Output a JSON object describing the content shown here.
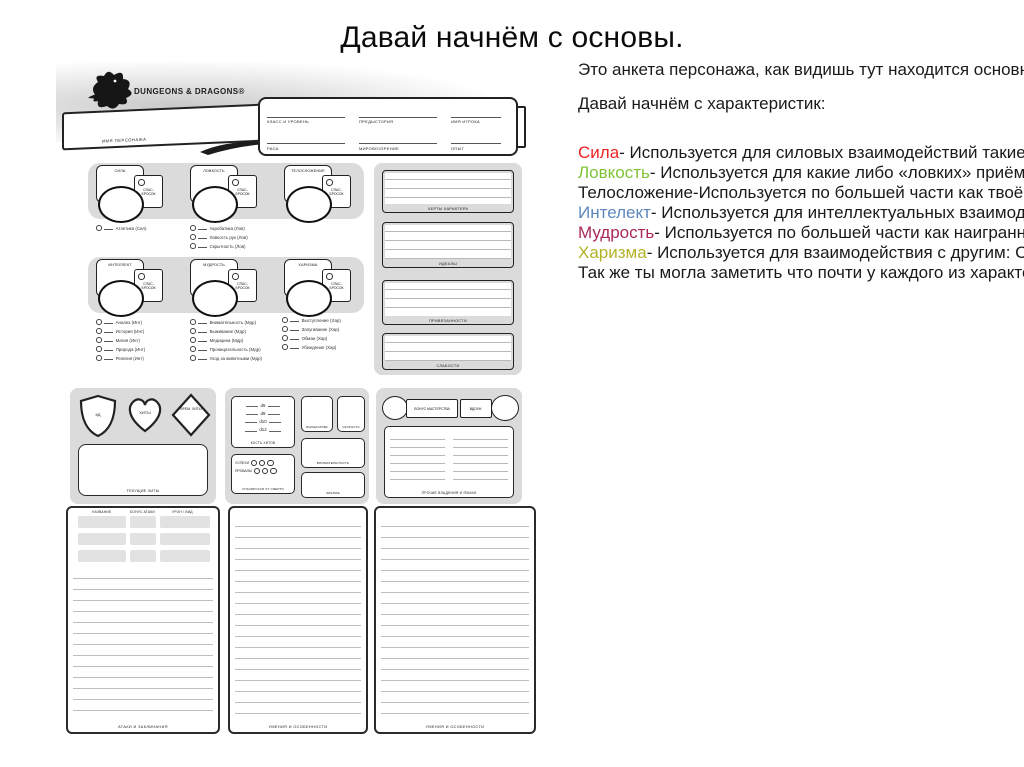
{
  "slide": {
    "title": "Давай начнём с основы."
  },
  "notes": {
    "lines": [
      {
        "text": "Это анкета персонажа, как видишь тут находится основн"
      },
      {
        "text": " Давай начнём с характеристик:"
      },
      {
        "term": "Сила",
        "color": "#ee2222",
        "rest": "- Используется для силовых взаимодействий такие"
      },
      {
        "term": "Ловкость",
        "color": "#7fc437",
        "rest": "- Используется для какие либо «ловких» приём"
      },
      {
        "text": "Телосложение-Используется по большей части как твоё"
      },
      {
        "term": "Интелект",
        "color": "#5e87bd",
        "rest": "- Используется для интеллектуальных взаимоде"
      },
      {
        "term": "Мудрость",
        "color": "#a82a5a",
        "rest": "- Используется по большей части как наигранн"
      },
      {
        "term": "Харизма",
        "color": "#b3b329",
        "rest": "- Используется для взаимодействия с другим: С"
      },
      {
        "text": "Так же ты могла заметить что почти у каждого из характе"
      }
    ]
  },
  "sheet": {
    "logo": "DUNGEONS & DRAGONS®",
    "name_label": "ИМЯ ПЕРСОНАЖА",
    "fields": [
      "КЛАСС И УРОВЕНЬ",
      "ПРЕДЫСТОРИЯ",
      "ИМЯ ИГРОКА",
      "РАСА",
      "МИРОВОЗЗРЕНИЕ",
      "ОПЫТ"
    ],
    "save_label": "СПАС-\nБРОСОК",
    "row1": [
      {
        "name": "СИЛА",
        "skills": [
          "Атлетика (Сил)"
        ]
      },
      {
        "name": "ЛОВКОСТЬ",
        "skills": [
          "Акробатика (Лов)",
          "Ловкость рук (Лов)",
          "Скрытность (Лов)"
        ]
      },
      {
        "name": "ТЕЛОСЛОЖЕНИЕ",
        "skills": []
      }
    ],
    "row2": [
      {
        "name": "ИНТЕЛЛЕКТ",
        "skills": [
          "Анализ (Инт)",
          "История (Инт)",
          "Магия (Инт)",
          "Природа (Инт)",
          "Религия (Инт)"
        ]
      },
      {
        "name": "МУДРОСТЬ",
        "skills": [
          "Внимательность (Мдр)",
          "Выживание (Мдр)",
          "Медицина (Мдр)",
          "Проницательность (Мдр)",
          "Уход за животными (Мдр)"
        ]
      },
      {
        "name": "ХАРИЗМА",
        "skills": [
          "Выступление (Хар)",
          "Запугивание (Хар)",
          "Обман (Хар)",
          "Убеждение (Хар)"
        ]
      }
    ],
    "traits": [
      "ЧЕРТЫ ХАРАКТЕРА",
      "ИДЕАЛЫ",
      "ПРИВЯЗАННОСТИ",
      "СЛАБОСТИ"
    ],
    "combat": {
      "ac": "КД",
      "hp": "ХИТЫ",
      "temp_hp": "ВРЕМ. ХИТЫ",
      "current_hp": "ТЕКУЩИЕ ХИТЫ"
    },
    "hit_dice": {
      "dice": [
        "d6",
        "d8",
        "d10",
        "d12"
      ],
      "label": "КОСТЬ ХИТОВ"
    },
    "death_saves": {
      "success": "УСПЕХИ",
      "fail": "ПРОВАЛЫ",
      "label": "СПАСБРОСКИ ОТ СМЕРТИ"
    },
    "senses": {
      "initiative": "ИНИЦИАТИВА",
      "speed": "СКОРОСТЬ",
      "perception": "ВНИМАТЕЛЬНОСТЬ",
      "vision": "ЗРЕНИЕ"
    },
    "prof": {
      "bonus": "БОНУС МАСТЕРСТВА",
      "inspiration": "ВДОХН.",
      "other": "ПРОЧИЕ ВЛАДЕНИЯ И ЯЗЫКИ"
    },
    "attacks": {
      "headers": [
        "НАЗВАНИЕ",
        "БОНУС АТАКИ",
        "УРОН / ВИД"
      ],
      "label": "АТАКИ И ЗАКЛИНАНИЯ"
    },
    "features_label": "УМЕНИЯ И ОСОБЕННОСТИ"
  }
}
